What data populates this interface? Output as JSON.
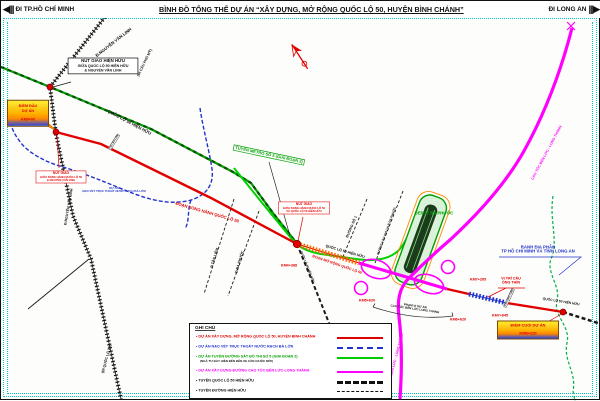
{
  "header": {
    "left_arrow": "◀|||",
    "left_destination": "ĐI TP.HỒ CHÍ MINH",
    "title": "BÌNH ĐỒ TỔNG THỂ DỰ ÁN “XÂY DỰNG, MỞ RỘNG QUỐC LỘ 50, HUYỆN BÌNH CHÁNH”",
    "right_destination": "ĐI LONG AN",
    "right_arrow": "|||▶"
  },
  "colors": {
    "project_red": "#e10000",
    "dredging_blue": "#2233cc",
    "metro_green": "#00cc00",
    "expressway_magenta": "#ff00ff",
    "existing_road_green": "#007a00",
    "frame_cyan": "#00c8c8",
    "highlight_orange": "#ff8800"
  },
  "callouts": {
    "existing_junction": {
      "line1": "NÚT GIAO HIỆN HỮU",
      "line2": "GIỮA QUỐC LỘ 50 HIỆN HỮU",
      "line3": "& NGUYỄN VĂN LINH"
    },
    "junction_nvl": {
      "line1": "NÚT GIAO",
      "line2": "GIỮA SONG HÀNH QUỐC LỘ 50",
      "line3": "& NGUYỄN VĂN LINH"
    },
    "junction_ql50": {
      "line1": "NÚT GIAO",
      "line2": "GIỮA SONG HÀNH QUỐC LỘ 50",
      "line3": "VÀ QUỐC LỘ 50 HIỆN HỮU"
    },
    "start_point": {
      "line1": "ĐIỂM ĐẦU DỰ ÁN",
      "line2": "KM0+00"
    },
    "end_point": {
      "line1": "ĐIỂM CUỐI DỰ ÁN",
      "line2": "KM8+220"
    },
    "bridge": {
      "line1": "VỊ TRÍ CẦU",
      "line2": "ÔNG THÌN"
    },
    "boundary": {
      "line1": "RANH ĐỊA PHẬN",
      "line2": "TP HỒ CHÍ MINH VÀ TỈNH LONG AN"
    },
    "dredging": {
      "line1": "DỰ ÁN",
      "line2": "NẠO VÉT TRỤC THOÁT NƯỚC RẠCH BÀ LỚN"
    },
    "scope": {
      "line1": "PHẠM VI DỰ ÁN",
      "line2": "CAO TỐC BẾN LỨC LONG THÀNH"
    }
  },
  "labels": {
    "nvl_road_top": "Đ.NGUYỄN VĂN LINH",
    "nvl_road_mid": "Đ.NGUYỄN VĂN LINH",
    "phu_my": "(ĐI CẦU PHÚ MỸ)",
    "ql1a": "(ĐI QUỐC LỘ 1A)",
    "ql50_existing_a": "QUỐC LỘ 50 HIỆN HỮU",
    "ql50_existing_b": "QUỐC LỘ 50 HIỆN HỮU",
    "ql50_existing_c": "QUỐC LỘ 50 HIỆN HỮU",
    "ql50_existing_d": "QUỐC LỘ 50 HIỆN HỮU",
    "parallel_section": "ĐOẠN SONG HÀNH QUỐC LỘ 50",
    "widening_section": "ĐOẠN MỞ RỘNG QUỐC LỘ 50",
    "metro": "TUYẾN METRO SỐ 5 (GIAI ĐOẠN 2)",
    "depot": "DEPOT ĐA PHƯỚC",
    "tan_liem": "Đ.TÂN LIÊM",
    "da_phuoc": "Đ.ĐA PHƯỚC",
    "duong_so_1": "ĐƯỜNG SỐ 1",
    "xlr_road": "ĐƯỜNG VÀO KHU XLR ĐA PHƯỚC",
    "expressway_a": "CAO TỐC BẾN LỨC - LONG THÀNH",
    "expressway_b": "CAO TỐC BẾN LỨC - LONG THÀNH",
    "bridge_ba_lon": "CẦU BÀ LỚN",
    "bridge_ong_thin": "CẦU ÔNG THÌN"
  },
  "km_markers": {
    "junction": "KM4+368",
    "expwy_start": "KM5+620",
    "expwy_end": "KM6+620",
    "bridge_start": "KM7+265",
    "bridge_end": "KM7+645"
  },
  "legend": {
    "title": "GHI CHÚ",
    "items": [
      {
        "label": "• DỰ ÁN XÂY DỰNG, MỞ RỘNG QUỐC LỘ 50, HUYỆN BÌNH CHÁNH",
        "color": "#e10000",
        "style": "solid-red"
      },
      {
        "label": "• DỰ ÁN NẠO VÉT TRỤC THOÁT NƯỚC RẠCH BÀ LỚN",
        "color": "#2233cc",
        "style": "dashed-blue"
      },
      {
        "label": "• DỰ ÁN TUYẾN ĐƯỜNG SẮT ĐÔ THỊ SỐ 5 (GIAI ĐOẠN 2)",
        "sublabel": "(NGÃ TƯ BẢY HIỀN ĐẾN BẾN XE CẦN GIUỘC MỚI)",
        "color": "#00cc00",
        "style": "solid-green"
      },
      {
        "label": "• DỰ ÁN XÂY DỰNG ĐƯỜNG CAO TỐC BẾN LỨC-LONG THÀNH",
        "color": "#ff00ff",
        "style": "solid-magenta"
      },
      {
        "label": "• TUYẾN QUỐC LỘ 50 HIỆN HỮU",
        "color": "#111111",
        "style": "dashed-black-thick"
      },
      {
        "label": "• TUYẾN ĐƯỜNG HIỆN HỮU",
        "color": "#111111",
        "style": "dashed-black-thin"
      }
    ]
  }
}
